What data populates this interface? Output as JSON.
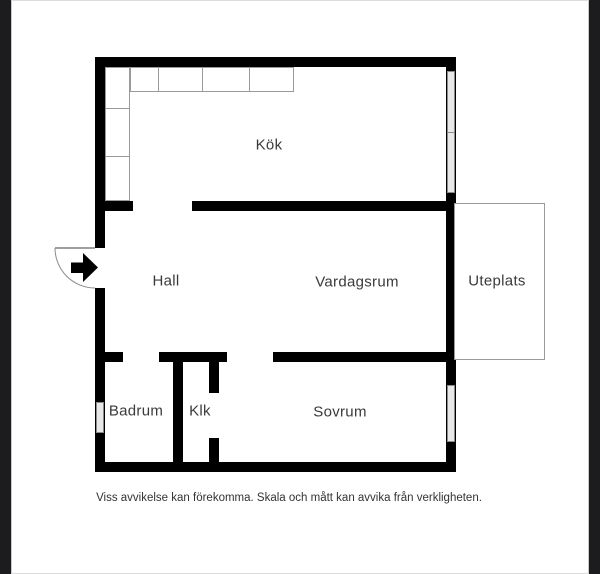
{
  "letterbox": {
    "color": "#1c1c1e"
  },
  "floorplan": {
    "wall_color": "#000000",
    "window_fill": "#e8e8e8",
    "outline_color": "#9a9a9a",
    "rooms": {
      "kitchen": {
        "label": "Kök"
      },
      "hall": {
        "label": "Hall"
      },
      "living_room": {
        "label": "Vardagsrum"
      },
      "patio": {
        "label": "Uteplats"
      },
      "bathroom": {
        "label": "Badrum"
      },
      "closet": {
        "label": "Klk"
      },
      "bedroom": {
        "label": "Sovrum"
      }
    },
    "symbols": {
      "entrance_arrow": "entrance-direction-arrow",
      "door_swing": "quarter-circle-door-swing",
      "windows": [
        "kitchen-window",
        "bedroom-window",
        "bathroom-window"
      ]
    },
    "disclaimer": "Viss avvikelse kan förekomma. Skala och mått kan avvika från verkligheten."
  }
}
